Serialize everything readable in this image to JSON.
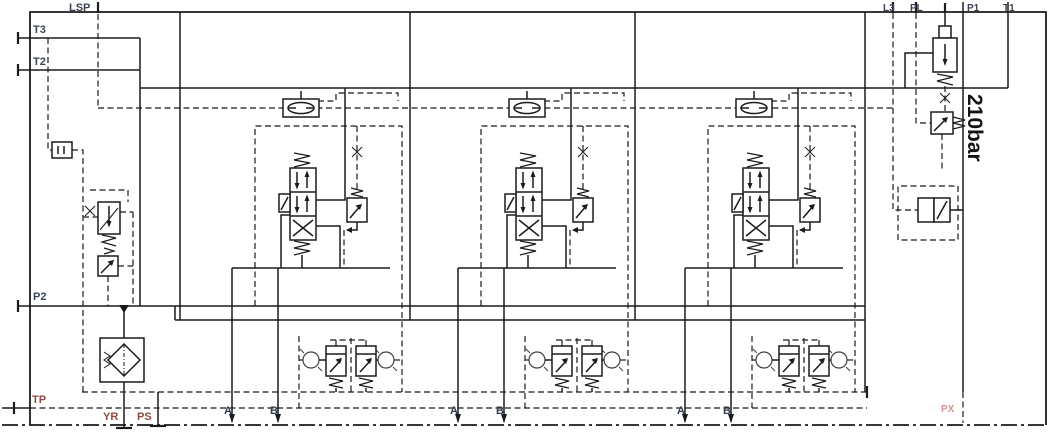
{
  "diagram": {
    "type": "hydraulic-valve-block-schematic",
    "pressure_rating": "210bar"
  },
  "labels": {
    "lsp": "LSP",
    "t3": "T3",
    "t2": "T2",
    "p2": "P2",
    "tp": "TP",
    "yr": "YR",
    "ps": "PS",
    "l3": "L3",
    "pl": "PL",
    "p1": "P1",
    "t1": "T1",
    "px": "PX",
    "pressure": "210bar"
  },
  "sections": [
    {
      "name": "work-section-1",
      "port_a": "A",
      "port_b": "B"
    },
    {
      "name": "work-section-2",
      "port_a": "A",
      "port_b": "B"
    },
    {
      "name": "work-section-3",
      "port_a": "A",
      "port_b": "B"
    }
  ],
  "colors": {
    "line": "#1b1b1b",
    "port_label": "#3b4455",
    "tank_label": "#8e4a3e",
    "work_label": "#333d52",
    "faint_label": "#bb7d76",
    "background": "#ffffff"
  }
}
